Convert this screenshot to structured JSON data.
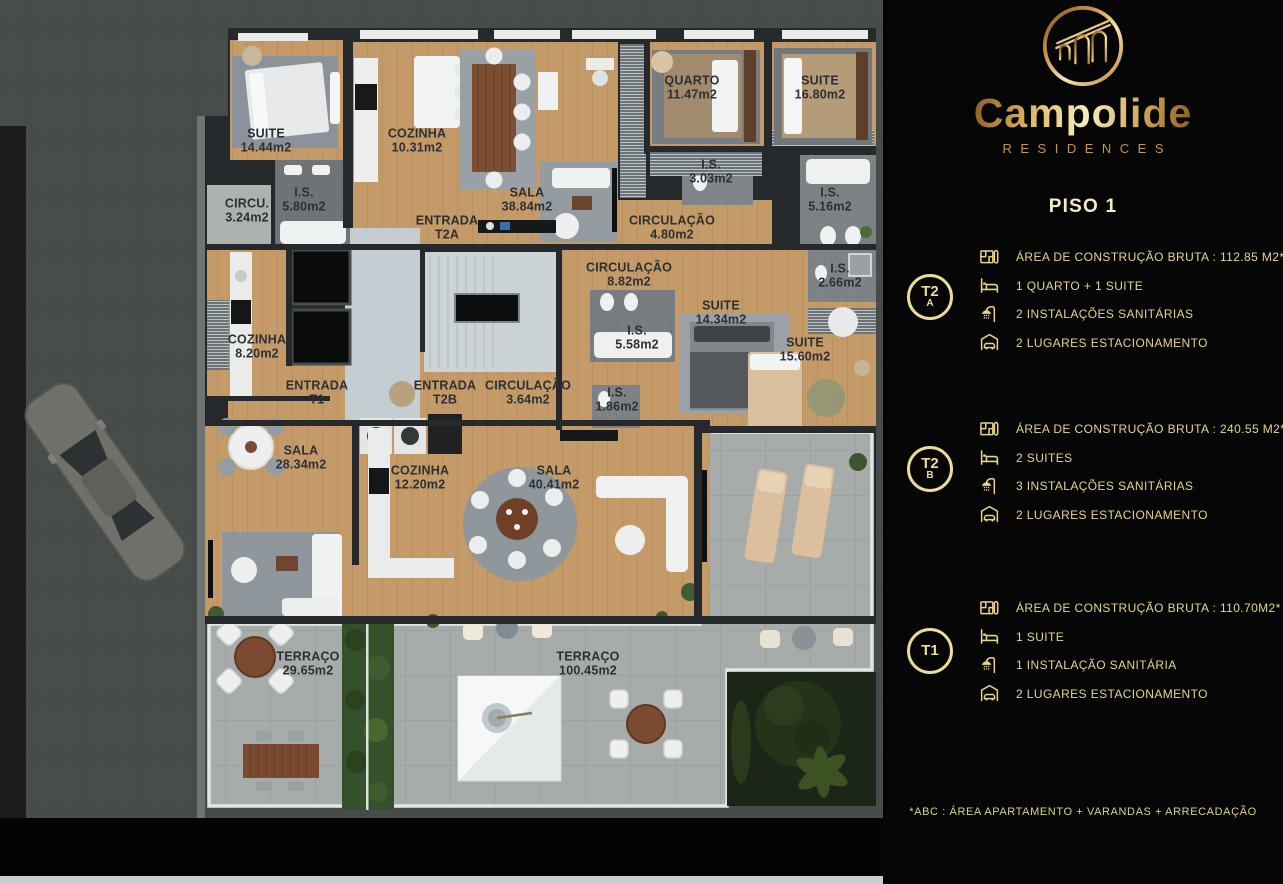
{
  "brand": {
    "name": "Campolide",
    "tagline": "RESIDENCES",
    "logo": "aqueduct-arches-in-gold-circle"
  },
  "page_title": "PISO 1",
  "colors": {
    "gold": "#e5d687",
    "gold_bright": "#f4edc3",
    "panel_bg": "#050505",
    "wood_floor": "#c49a68",
    "terrace": "#a7acab",
    "wall": "#26292c"
  },
  "units": [
    {
      "badge_main": "T2",
      "badge_sub": "A",
      "rows": [
        {
          "icon": "floorplan-icon",
          "text": "ÁREA DE CONSTRUÇÃO BRUTA : 112.85 M2*"
        },
        {
          "icon": "bed-icon",
          "text": "1 QUARTO + 1 SUITE"
        },
        {
          "icon": "shower-icon",
          "text": "2 INSTALAÇÕES SANITÁRIAS"
        },
        {
          "icon": "garage-icon",
          "text": "2 LUGARES ESTACIONAMENTO"
        }
      ]
    },
    {
      "badge_main": "T2",
      "badge_sub": "B",
      "rows": [
        {
          "icon": "floorplan-icon",
          "text": "ÁREA DE CONSTRUÇÃO BRUTA : 240.55 M2*"
        },
        {
          "icon": "bed-icon",
          "text": "2 SUITES"
        },
        {
          "icon": "shower-icon",
          "text": "3 INSTALAÇÕES SANITÁRIAS"
        },
        {
          "icon": "garage-icon",
          "text": "2 LUGARES ESTACIONAMENTO"
        }
      ]
    },
    {
      "badge_main": "T1",
      "badge_sub": "",
      "rows": [
        {
          "icon": "floorplan-icon",
          "text": "ÁREA DE CONSTRUÇÃO BRUTA : 110.70M2*"
        },
        {
          "icon": "bed-icon",
          "text": "1 SUITE"
        },
        {
          "icon": "shower-icon",
          "text": "1 INSTALAÇÃO SANITÁRIA"
        },
        {
          "icon": "garage-icon",
          "text": "2 LUGARES ESTACIONAMENTO"
        }
      ]
    }
  ],
  "footnote": "*ABC :  ÁREA APARTAMENTO + VARANDAS + ARRECADAÇÃO",
  "floorplan": {
    "rooms": [
      {
        "name": "SUITE",
        "area": "14.44m2"
      },
      {
        "name": "COZINHA",
        "area": "10.31m2"
      },
      {
        "name": "SALA",
        "area": "38.84m2"
      },
      {
        "name": "QUARTO",
        "area": "11.47m2"
      },
      {
        "name": "SUITE",
        "area": "16.80m2"
      },
      {
        "name": "I.S.",
        "area": "5.80m2"
      },
      {
        "name": "CIRCU.",
        "area": "3.24m2"
      },
      {
        "name": "ENTRADA",
        "area": "T2A"
      },
      {
        "name": "I.S.",
        "area": "3.03m2"
      },
      {
        "name": "I.S.",
        "area": "5.16m2"
      },
      {
        "name": "CIRCULAÇÃO",
        "area": "4.80m2"
      },
      {
        "name": "CIRCULAÇÃO",
        "area": "8.82m2"
      },
      {
        "name": "I.S.",
        "area": "2.66m2"
      },
      {
        "name": "SUITE",
        "area": "14.34m2"
      },
      {
        "name": "I.S.",
        "area": "5.58m2"
      },
      {
        "name": "SUITE",
        "area": "15.60m2"
      },
      {
        "name": "COZINHA",
        "area": "8.20m2"
      },
      {
        "name": "ENTRADA",
        "area": "T1"
      },
      {
        "name": "ENTRADA",
        "area": "T2B"
      },
      {
        "name": "CIRCULAÇÃO",
        "area": "3.64m2"
      },
      {
        "name": "I.S.",
        "area": "1.86m2"
      },
      {
        "name": "SALA",
        "area": "28.34m2"
      },
      {
        "name": "COZINHA",
        "area": "12.20m2"
      },
      {
        "name": "SALA",
        "area": "40.41m2"
      },
      {
        "name": "TERRAÇO",
        "area": "29.65m2"
      },
      {
        "name": "TERRAÇO",
        "area": "100.45m2"
      }
    ]
  }
}
